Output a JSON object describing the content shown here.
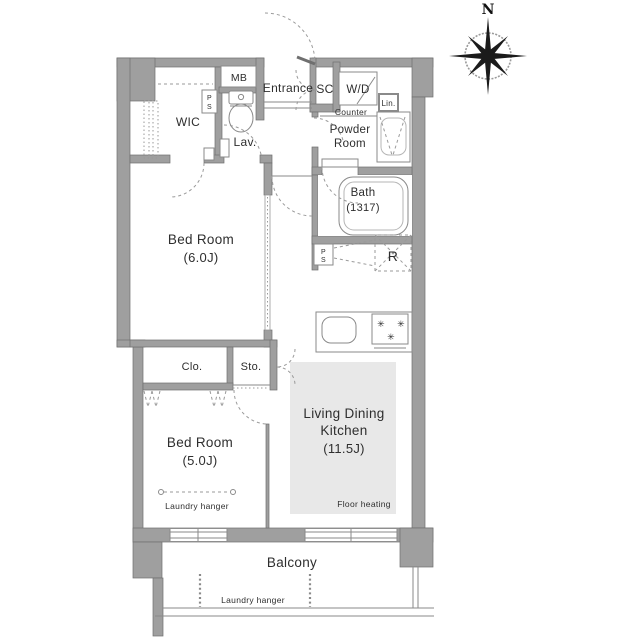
{
  "colors": {
    "wall": "#9f9f9f",
    "wall_edge": "#6f6f6f",
    "line": "#8a8a8a",
    "dash": "#9a9a9a",
    "text": "#2e2e2e",
    "floor_heating": "#e8e8e8"
  },
  "compass": {
    "north_label": "N"
  },
  "labels": {
    "mb": "MB",
    "wic": "WIC",
    "lav": "Lav.",
    "entrance": "Entrance",
    "sc": "SC",
    "wd": "W/D",
    "counter": "Counter",
    "lin": "Lin.",
    "powder_line1": "Powder",
    "powder_line2": "Room",
    "bath": "Bath",
    "bath_size": "(1317)",
    "ps_p": "P",
    "ps_s": "S",
    "refrigerator": "R",
    "bedroom1": "Bed Room",
    "bedroom1_size": "(6.0J)",
    "clo": "Clo.",
    "sto": "Sto.",
    "bedroom2": "Bed Room",
    "bedroom2_size": "(5.0J)",
    "laundry_bedroom": "Laundry hanger",
    "ldk_line1": "Living Dining",
    "ldk_line2": "Kitchen",
    "ldk_size": "(11.5J)",
    "floor_heating": "Floor heating",
    "balcony": "Balcony",
    "laundry_balcony": "Laundry hanger"
  }
}
